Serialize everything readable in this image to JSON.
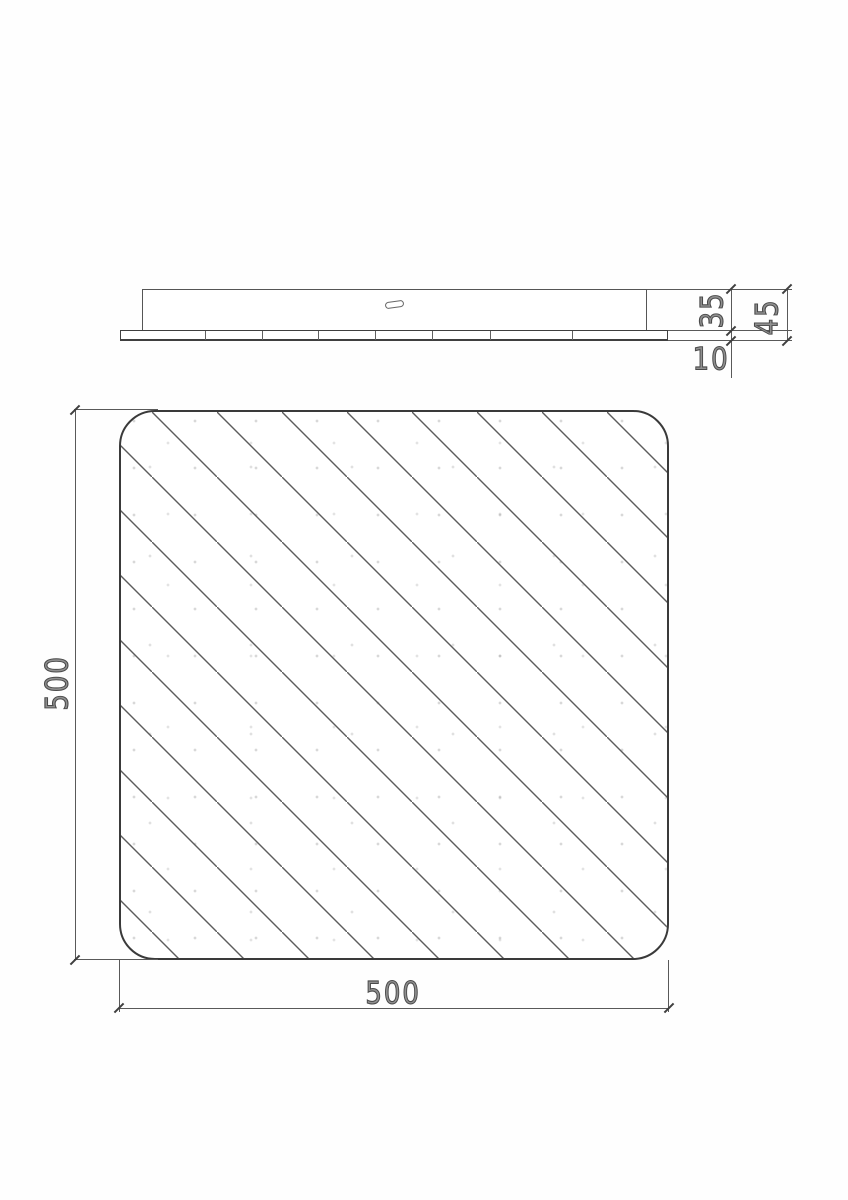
{
  "document": {
    "type_note": "technical CAD dimension drawing, panel light 500x500",
    "background_color": "#ffffff",
    "line_color": "#4a4a4a"
  },
  "side_view": {
    "dim_body_height": "35",
    "dim_total_height": "45",
    "dim_plate_thickness": "10"
  },
  "plan_view": {
    "dim_height": "500",
    "dim_width": "500"
  }
}
